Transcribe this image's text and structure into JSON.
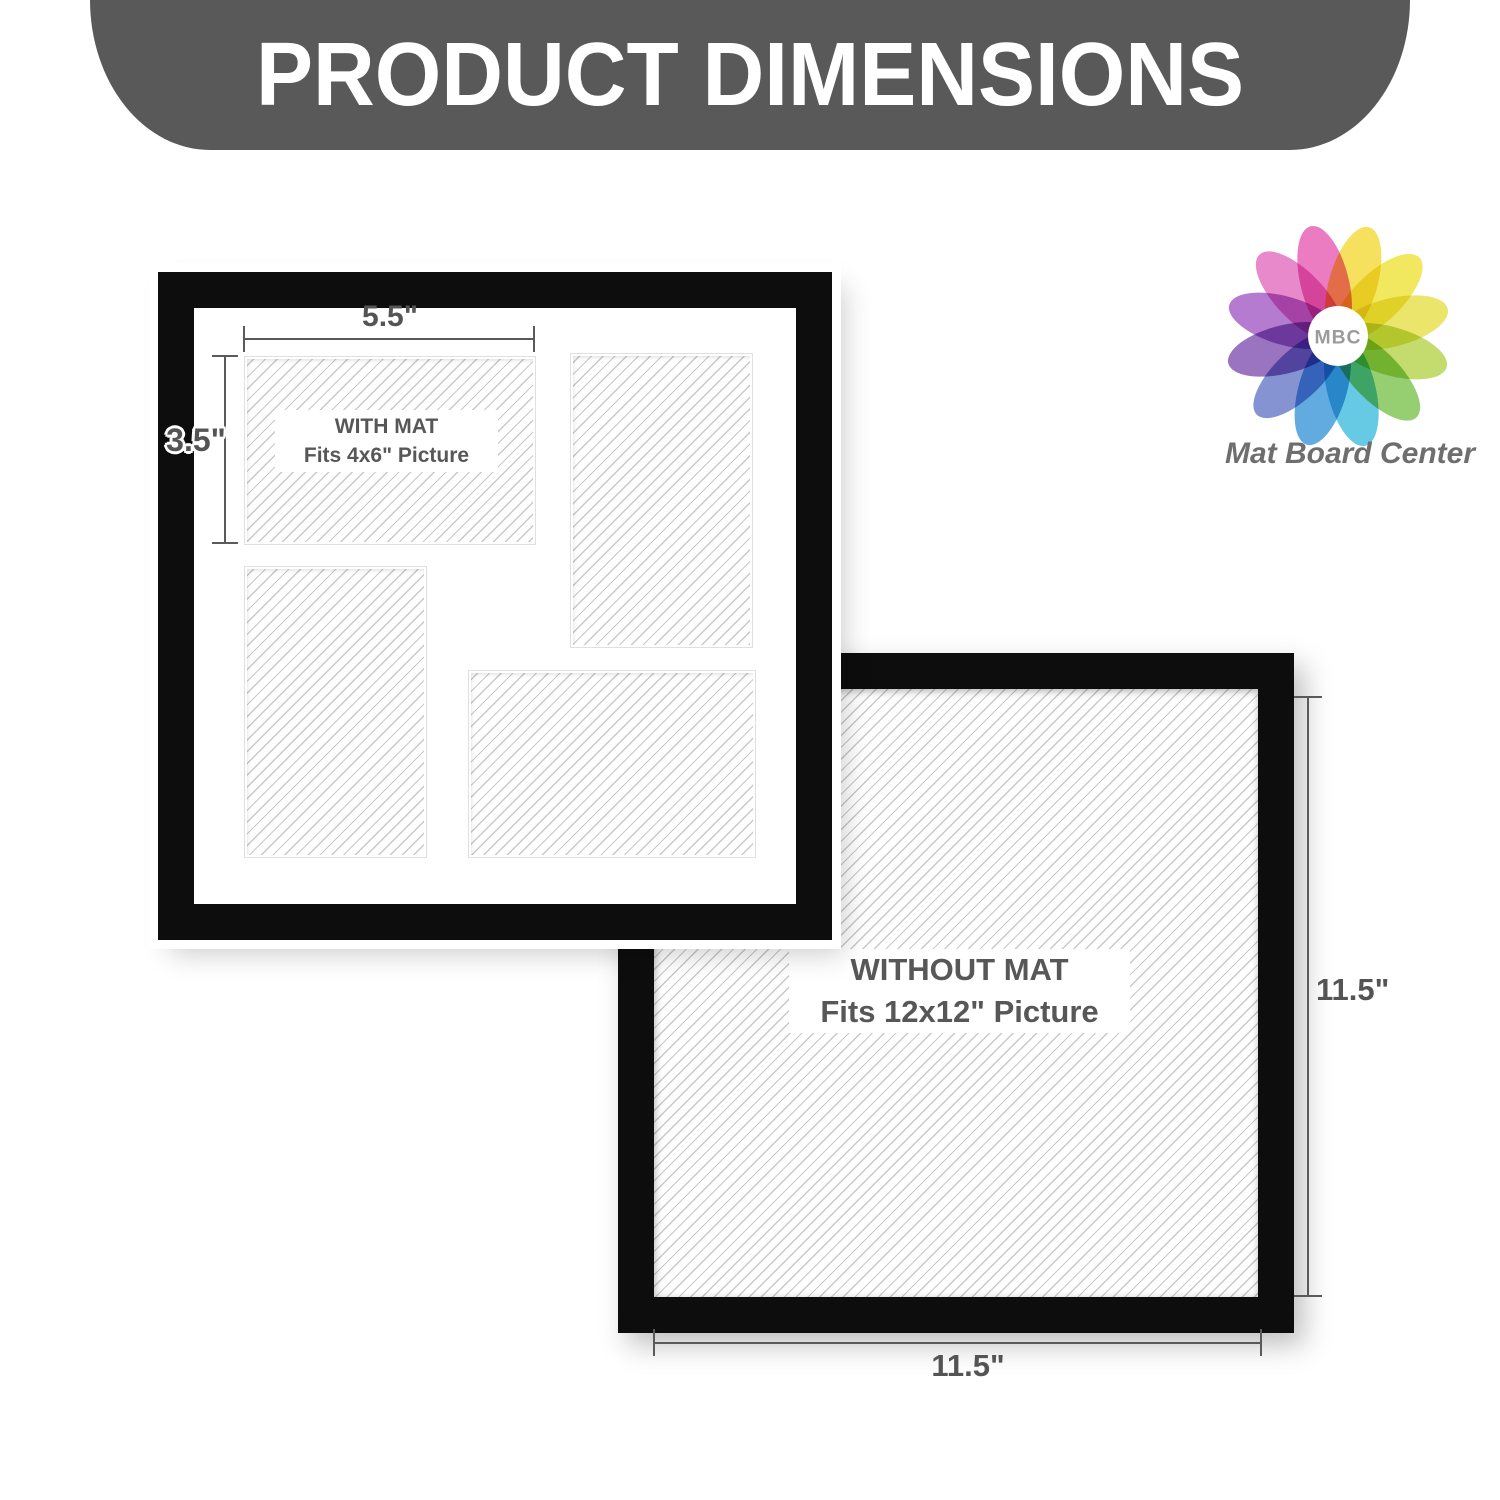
{
  "banner": {
    "title": "PRODUCT DIMENSIONS",
    "bg_color": "#595959",
    "text_color": "#ffffff"
  },
  "logo": {
    "monogram": "MBC",
    "brand": "Mat Board Center",
    "monogram_color": "#9b9b9b",
    "brand_color": "#6e6e6e",
    "petal_colors": [
      "#e85fb4",
      "#f3da3b",
      "#efe33c",
      "#e6e04b",
      "#b7d44e",
      "#7fc453",
      "#45bede",
      "#3f99da",
      "#6b7bc8",
      "#8455b2",
      "#a55ec6",
      "#e36fc0"
    ]
  },
  "frame_with_mat": {
    "caption_line1": "WITH MAT",
    "caption_line2": "Fits 4x6\" Picture",
    "width_label": "5.5\"",
    "height_label": "3.5\""
  },
  "frame_without_mat": {
    "caption_line1": "WITHOUT MAT",
    "caption_line2": "Fits 12x12\" Picture",
    "width_label": "11.5\"",
    "height_label": "11.5\""
  },
  "colors": {
    "frame_black": "#0d0d0d",
    "mat_white": "#ffffff",
    "hatch_line": "#c9c9c9",
    "dimension_text": "#545454",
    "caption_text": "#575757"
  }
}
